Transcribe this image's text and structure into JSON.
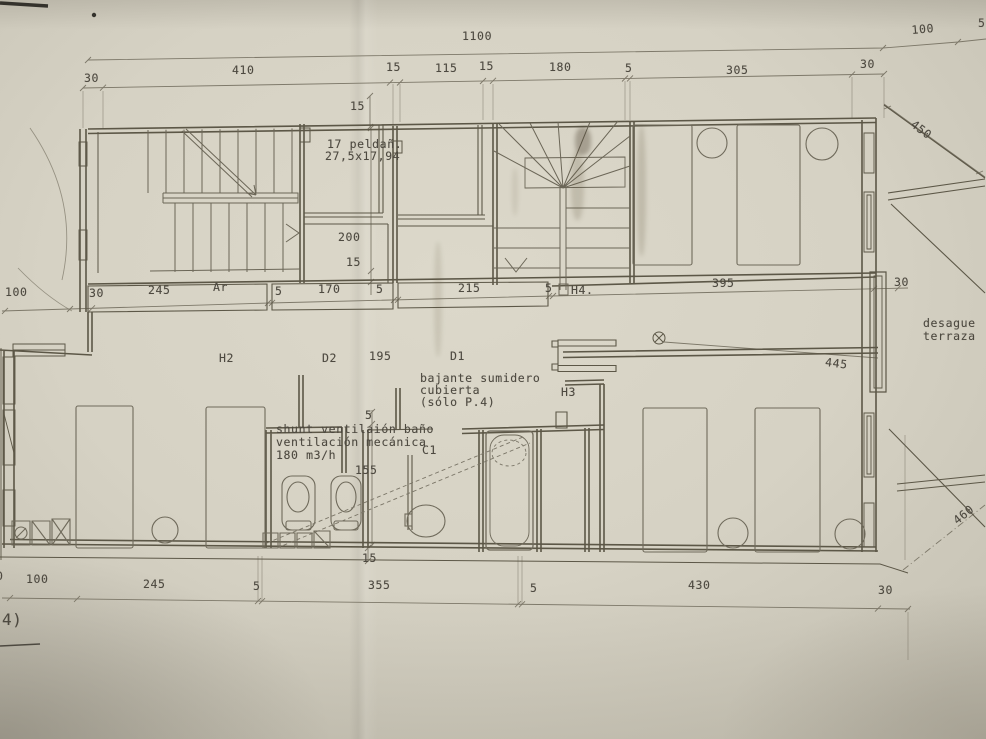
{
  "drawing": {
    "kind": "architectural floor plan (scanned blueprint, planta P.4)",
    "sheet_note": "4)",
    "paper_color": "#d6d2c4",
    "ink_color": "#5c5747",
    "dim_color": "#7d7869",
    "text_color": "#4d4940"
  },
  "annotations": {
    "stair_note_line1": "17 peldañ.",
    "stair_note_line2": "27,5x17,94",
    "drain_note_line1": "desague",
    "drain_note_line2": "terraza",
    "bajante_line1": "bajante sumidero",
    "bajante_line2": "cubierta",
    "bajante_line3": "(sólo P.4)",
    "shunt_line1": "shunt ventilaión baño",
    "shunt_line2": "ventilación mecánica",
    "shunt_line3": "180 m3/h"
  },
  "rooms": [
    "H2",
    "D2",
    "D1",
    "C1",
    "H3",
    "H4.",
    "Ar"
  ],
  "dimension_chains": {
    "top_overall": [
      "1100",
      "100",
      "5"
    ],
    "top_segments": [
      "30",
      "410",
      "15",
      "115",
      "15",
      "180",
      "5",
      "305",
      "30",
      "15"
    ],
    "middle": [
      "100",
      "30",
      "245",
      "5",
      "170",
      "5",
      "215",
      "5",
      "395",
      "30",
      "195"
    ],
    "vertical": [
      "200",
      "15",
      "5",
      "155",
      "15"
    ],
    "bottom": [
      "0",
      "100",
      "245",
      "5",
      "355",
      "5",
      "430",
      "30"
    ],
    "terrace_diagonals": [
      "450",
      "460",
      "445"
    ]
  },
  "labels": [
    {
      "n": "dim-overall-1100",
      "t": "1100",
      "x": 462,
      "y": 30
    },
    {
      "n": "dim-top-30-left",
      "t": "30",
      "x": 84,
      "y": 72
    },
    {
      "n": "dim-top-410",
      "t": "410",
      "x": 232,
      "y": 64
    },
    {
      "n": "dim-top-15a",
      "t": "15",
      "x": 386,
      "y": 61
    },
    {
      "n": "dim-top-115",
      "t": "115",
      "x": 435,
      "y": 62
    },
    {
      "n": "dim-top-15b",
      "t": "15",
      "x": 479,
      "y": 60
    },
    {
      "n": "dim-top-180",
      "t": "180",
      "x": 549,
      "y": 61
    },
    {
      "n": "dim-top-5",
      "t": "5",
      "x": 625,
      "y": 62
    },
    {
      "n": "dim-top-305",
      "t": "305",
      "x": 726,
      "y": 64
    },
    {
      "n": "dim-top-30-right",
      "t": "30",
      "x": 860,
      "y": 58
    },
    {
      "n": "dim-top-100",
      "t": "100",
      "x": 911,
      "y": 24,
      "r": -5
    },
    {
      "n": "dim-top-5-edge",
      "t": "5",
      "x": 978,
      "y": 17
    },
    {
      "n": "dim-wall-15",
      "t": "15",
      "x": 350,
      "y": 100
    },
    {
      "n": "note-stair-1",
      "t": "17 peldañ.",
      "x": 327,
      "y": 138
    },
    {
      "n": "note-stair-2",
      "t": "27,5x17,94",
      "x": 325,
      "y": 150
    },
    {
      "n": "dim-v-200",
      "t": "200",
      "x": 338,
      "y": 231
    },
    {
      "n": "dim-v-15",
      "t": "15",
      "x": 346,
      "y": 256
    },
    {
      "n": "dim-mid-100",
      "t": "100",
      "x": 5,
      "y": 286
    },
    {
      "n": "dim-mid-30",
      "t": "30",
      "x": 89,
      "y": 287
    },
    {
      "n": "dim-mid-245",
      "t": "245",
      "x": 148,
      "y": 284
    },
    {
      "n": "label-armario",
      "t": "Ar",
      "x": 213,
      "y": 281
    },
    {
      "n": "dim-mid-5a",
      "t": "5",
      "x": 275,
      "y": 285
    },
    {
      "n": "dim-mid-170",
      "t": "170",
      "x": 318,
      "y": 283
    },
    {
      "n": "dim-mid-5b",
      "t": "5",
      "x": 376,
      "y": 283
    },
    {
      "n": "dim-mid-215",
      "t": "215",
      "x": 458,
      "y": 282
    },
    {
      "n": "dim-mid-5c",
      "t": "5",
      "x": 545,
      "y": 282
    },
    {
      "n": "label-h4",
      "t": "H4.",
      "x": 571,
      "y": 284
    },
    {
      "n": "dim-mid-395",
      "t": "395",
      "x": 712,
      "y": 277
    },
    {
      "n": "dim-mid-30r",
      "t": "30",
      "x": 894,
      "y": 276
    },
    {
      "n": "note-desague-1",
      "t": "desague",
      "x": 923,
      "y": 317
    },
    {
      "n": "note-desague-2",
      "t": "terraza",
      "x": 923,
      "y": 330
    },
    {
      "n": "label-h2",
      "t": "H2",
      "x": 219,
      "y": 352
    },
    {
      "n": "label-d2",
      "t": "D2",
      "x": 322,
      "y": 352
    },
    {
      "n": "dim-195",
      "t": "195",
      "x": 369,
      "y": 350
    },
    {
      "n": "label-d1",
      "t": "D1",
      "x": 450,
      "y": 350
    },
    {
      "n": "note-bajante-1",
      "t": "bajante sumidero",
      "x": 420,
      "y": 372
    },
    {
      "n": "note-bajante-2",
      "t": "cubierta",
      "x": 420,
      "y": 384
    },
    {
      "n": "note-bajante-3",
      "t": "(sólo P.4)",
      "x": 420,
      "y": 396
    },
    {
      "n": "label-h3",
      "t": "H3",
      "x": 561,
      "y": 386
    },
    {
      "n": "dim-445",
      "t": "445",
      "x": 826,
      "y": 356,
      "r": 7
    },
    {
      "n": "dim-v-5",
      "t": "5",
      "x": 365,
      "y": 409
    },
    {
      "n": "note-shunt-1",
      "t": "shunt ventilaión baño",
      "x": 276,
      "y": 423
    },
    {
      "n": "note-shunt-2",
      "t": "ventilación mecánica",
      "x": 276,
      "y": 436
    },
    {
      "n": "note-shunt-3",
      "t": "180 m3/h",
      "x": 276,
      "y": 449
    },
    {
      "n": "label-c1",
      "t": "C1",
      "x": 422,
      "y": 444
    },
    {
      "n": "dim-v-155",
      "t": "155",
      "x": 355,
      "y": 464
    },
    {
      "n": "dim-v-15b",
      "t": "15",
      "x": 362,
      "y": 552
    },
    {
      "n": "dim-bot-0",
      "t": "0",
      "x": -4,
      "y": 570
    },
    {
      "n": "dim-bot-100",
      "t": "100",
      "x": 26,
      "y": 573
    },
    {
      "n": "dim-bot-245",
      "t": "245",
      "x": 143,
      "y": 578
    },
    {
      "n": "dim-bot-5a",
      "t": "5",
      "x": 253,
      "y": 580
    },
    {
      "n": "dim-bot-355",
      "t": "355",
      "x": 368,
      "y": 579
    },
    {
      "n": "dim-bot-5b",
      "t": "5",
      "x": 530,
      "y": 582
    },
    {
      "n": "dim-bot-430",
      "t": "430",
      "x": 688,
      "y": 579
    },
    {
      "n": "dim-bot-30",
      "t": "30",
      "x": 878,
      "y": 584
    },
    {
      "n": "dim-diag-450",
      "t": "450",
      "x": 916,
      "y": 118,
      "r": 37
    },
    {
      "n": "dim-diag-460",
      "t": "460",
      "x": 951,
      "y": 517,
      "r": -39
    },
    {
      "n": "sheet-note",
      "t": "4)",
      "x": 2,
      "y": 612,
      "s": 16
    }
  ]
}
